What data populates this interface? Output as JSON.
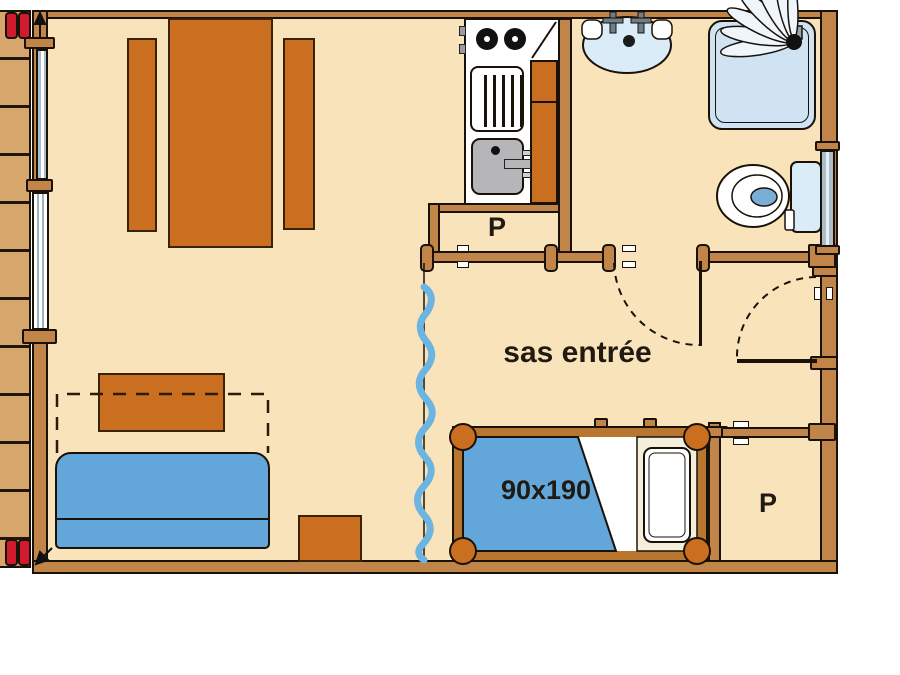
{
  "labels": {
    "entry_hall": "sas entrée",
    "bed_size": "90x190",
    "kitchen_closet": "P",
    "bedroom_closet": "P"
  },
  "colors": {
    "floor": "#f9e3ba",
    "wall_wood": "#c1854a",
    "deck_wood": "#d6a66d",
    "furniture_orange": "#c96f1f",
    "textile_blue": "#63a7da",
    "curtain_blue": "#6cb4e2",
    "fixture_blue": "#d9ecf8",
    "shower_blue": "#cfe3f2",
    "window_grey": "#a9bdcb",
    "sink_grey": "#b6b6b8",
    "accent_red": "#d21a2e",
    "outline": "#1a1208"
  }
}
